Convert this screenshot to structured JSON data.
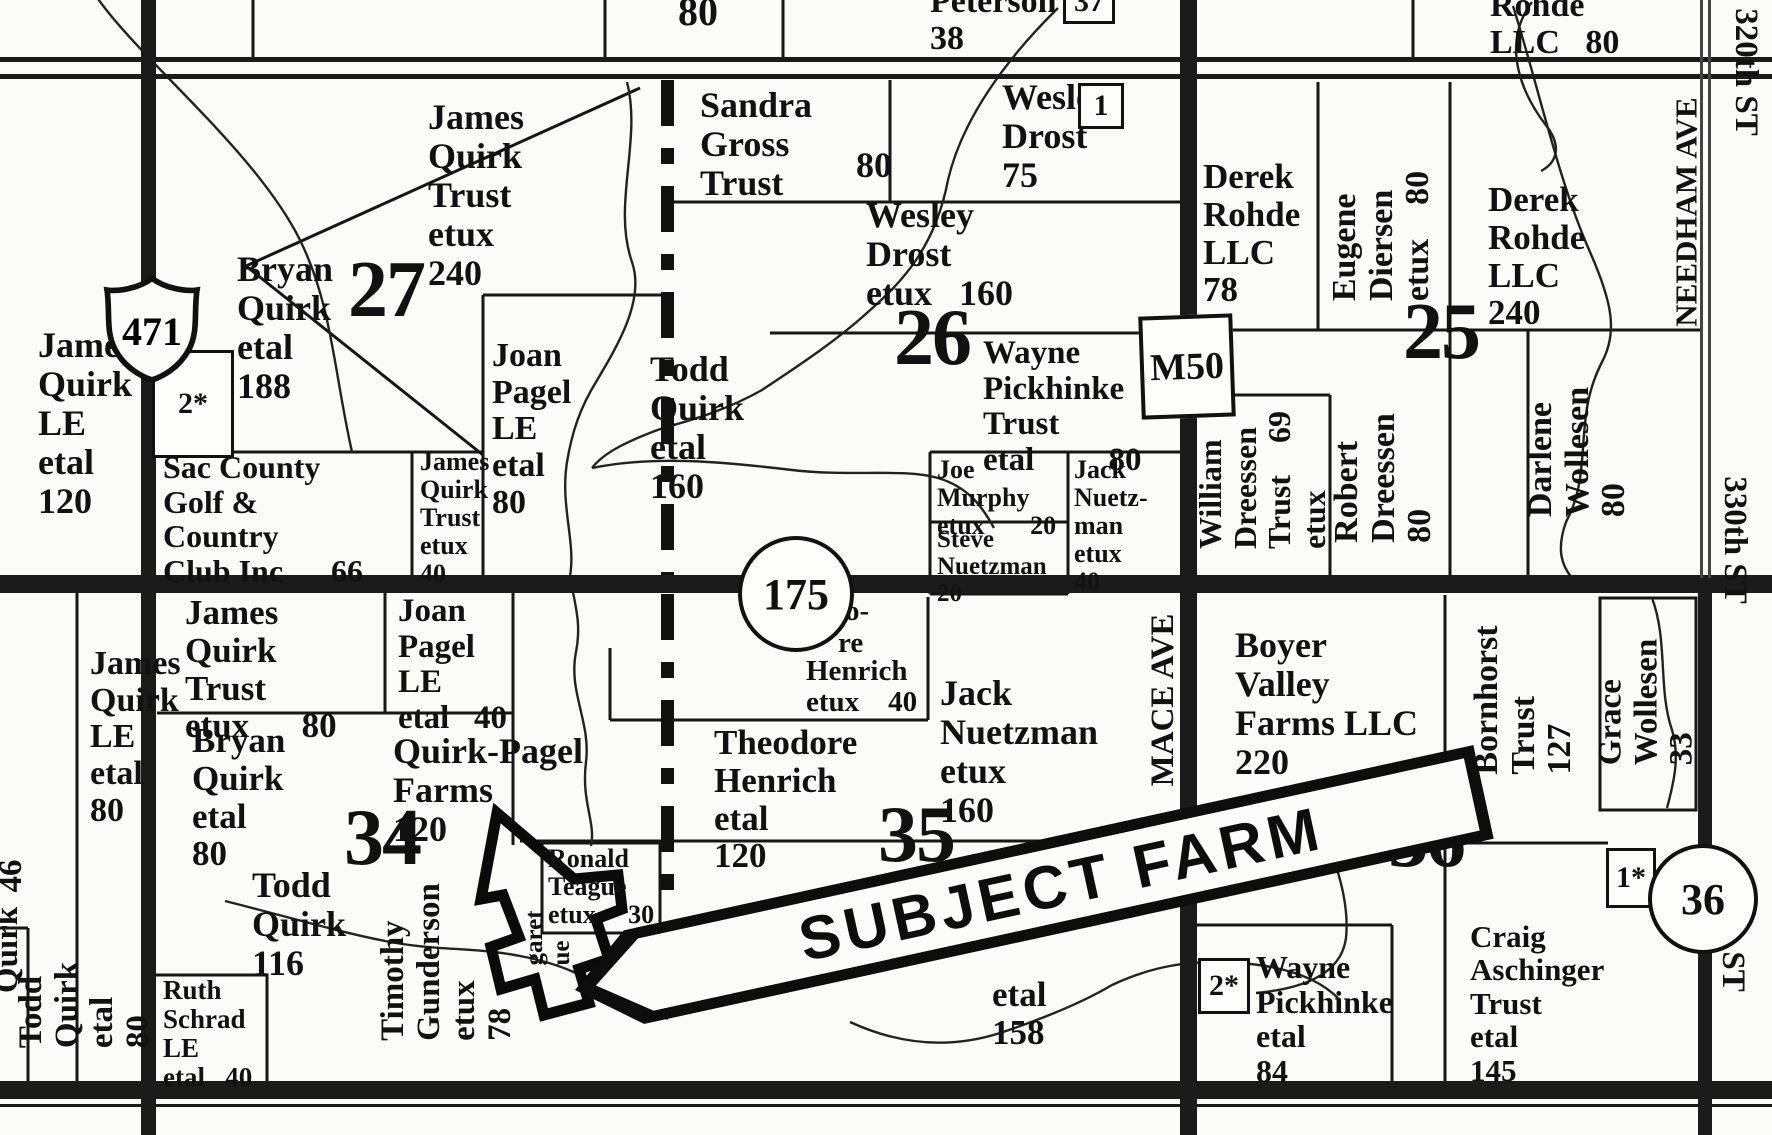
{
  "banner": {
    "label": "SUBJECT FARM"
  },
  "markers": {
    "us_shield": {
      "label": "471"
    },
    "m50_box": {
      "label": "M50"
    },
    "circle_175": {
      "label": "175"
    },
    "circle_36": {
      "label": "36"
    }
  },
  "section_numbers": [
    {
      "n": "27",
      "x": 348,
      "y": 250
    },
    {
      "n": "26",
      "x": 894,
      "y": 298
    },
    {
      "n": "25",
      "x": 1403,
      "y": 292
    },
    {
      "n": "34",
      "x": 344,
      "y": 798
    },
    {
      "n": "35",
      "x": 878,
      "y": 795
    },
    {
      "n": "36",
      "x": 1388,
      "y": 800
    }
  ],
  "badges": [
    {
      "t": "37",
      "x": 1063,
      "y": -20,
      "w": 46,
      "h": 38
    },
    {
      "t": "1",
      "x": 1078,
      "y": 83,
      "w": 40,
      "h": 40
    },
    {
      "t": "2*",
      "x": 152,
      "y": 350,
      "w": 76,
      "h": 102
    },
    {
      "t": "2*",
      "x": 1198,
      "y": 958,
      "w": 46,
      "h": 50
    },
    {
      "t": "1*",
      "x": 1606,
      "y": 848,
      "w": 44,
      "h": 54
    }
  ],
  "labels": [
    {
      "t": [
        "80"
      ],
      "x": 678,
      "y": -10,
      "fs": 40
    },
    {
      "t": [
        "Peterson",
        "38"
      ],
      "x": 930,
      "y": -16,
      "fs": 34
    },
    {
      "t": [
        "Rohde",
        "LLC   80"
      ],
      "x": 1490,
      "y": -12,
      "fs": 34
    },
    {
      "t": [
        "James",
        "Quirk",
        "Trust",
        "etux",
        "240"
      ],
      "x": 428,
      "y": 98,
      "fs": 36
    },
    {
      "t": [
        "Sandra",
        "Gross",
        "Trust"
      ],
      "x": 700,
      "y": 86,
      "fs": 36
    },
    {
      "t": [
        "80"
      ],
      "x": 856,
      "y": 146,
      "fs": 36
    },
    {
      "t": [
        "Wesley",
        "Drost",
        "75"
      ],
      "x": 1002,
      "y": 78,
      "fs": 36
    },
    {
      "t": [
        "Wesley",
        "Drost",
        "etux   160"
      ],
      "x": 866,
      "y": 196,
      "fs": 36
    },
    {
      "t": [
        "Derek",
        "Rohde",
        "LLC",
        "78"
      ],
      "x": 1203,
      "y": 158,
      "fs": 35
    },
    {
      "t": [
        "Derek",
        "Rohde",
        "LLC",
        "240"
      ],
      "x": 1488,
      "y": 181,
      "fs": 35
    },
    {
      "t": [
        "Bryan",
        "Quirk",
        "etal",
        "188"
      ],
      "x": 237,
      "y": 250,
      "fs": 36
    },
    {
      "t": [
        "James",
        "Quirk",
        "LE",
        "etal",
        "120"
      ],
      "x": 38,
      "y": 326,
      "fs": 36
    },
    {
      "t": [
        "Joan",
        "Pagel",
        "LE",
        "etal",
        "80"
      ],
      "x": 492,
      "y": 338,
      "fs": 34
    },
    {
      "t": [
        "Todd",
        "Quirk",
        "etal",
        "160"
      ],
      "x": 650,
      "y": 350,
      "fs": 36
    },
    {
      "t": [
        "Wayne",
        "Pickhinke",
        "Trust",
        "etal         80"
      ],
      "x": 983,
      "y": 336,
      "fs": 33
    },
    {
      "t": [
        "Sac County",
        "Golf &",
        "Country",
        "Club Inc      66"
      ],
      "x": 163,
      "y": 450,
      "fs": 32
    },
    {
      "t": [
        "James",
        "Quirk",
        "Trust",
        "etux",
        "40"
      ],
      "x": 420,
      "y": 448,
      "fs": 26
    },
    {
      "t": [
        "Joe",
        "Murphy",
        "etux       20"
      ],
      "x": 937,
      "y": 456,
      "fs": 26
    },
    {
      "t": [
        "Steve",
        "Nuetzman",
        "20"
      ],
      "x": 937,
      "y": 526,
      "fs": 25
    },
    {
      "t": [
        "Jack",
        "Nuetz-",
        "man",
        "etux",
        "40"
      ],
      "x": 1074,
      "y": 456,
      "fs": 26
    },
    {
      "t": [
        "James",
        "Quirk",
        "Trust",
        "etux      80"
      ],
      "x": 185,
      "y": 594,
      "fs": 35
    },
    {
      "t": [
        "Joan",
        "Pagel",
        "LE",
        "etal   40"
      ],
      "x": 398,
      "y": 594,
      "fs": 33
    },
    {
      "t": [
        "James",
        "Quirk",
        "LE",
        "etal",
        "80"
      ],
      "x": 90,
      "y": 646,
      "fs": 34
    },
    {
      "t": [
        "Bryan",
        "Quirk",
        "etal",
        "80"
      ],
      "x": 192,
      "y": 722,
      "fs": 35
    },
    {
      "t": [
        "Quirk-Pagel",
        "Farms",
        "120"
      ],
      "x": 393,
      "y": 732,
      "fs": 36
    },
    {
      "t": [
        "o-"
      ],
      "x": 845,
      "y": 596,
      "fs": 29
    },
    {
      "t": [
        "re"
      ],
      "x": 838,
      "y": 628,
      "fs": 29
    },
    {
      "t": [
        "Henrich",
        "etux    40"
      ],
      "x": 806,
      "y": 656,
      "fs": 29
    },
    {
      "t": [
        "Theodore",
        "Henrich",
        "etal",
        "120"
      ],
      "x": 714,
      "y": 724,
      "fs": 35
    },
    {
      "t": [
        "Jack",
        "Nuetzman",
        "etux",
        "160"
      ],
      "x": 940,
      "y": 674,
      "fs": 36
    },
    {
      "t": [
        "Boyer",
        "Valley",
        "Farms LLC",
        "220"
      ],
      "x": 1235,
      "y": 626,
      "fs": 36
    },
    {
      "t": [
        "Ronald",
        "Teague",
        "etux     30"
      ],
      "x": 548,
      "y": 845,
      "fs": 26
    },
    {
      "t": [
        "Todd",
        "Quirk",
        "116"
      ],
      "x": 252,
      "y": 866,
      "fs": 36
    },
    {
      "t": [
        "Ruth",
        "Schrad",
        "LE",
        "etal   40"
      ],
      "x": 163,
      "y": 976,
      "fs": 27
    },
    {
      "t": [
        "etal",
        "158"
      ],
      "x": 992,
      "y": 976,
      "fs": 35
    },
    {
      "t": [
        "D"
      ],
      "x": 734,
      "y": 916,
      "fs": 38
    },
    {
      "t": [
        "Wayne",
        "Pickhinke",
        "etal",
        "84"
      ],
      "x": 1256,
      "y": 950,
      "fs": 32
    },
    {
      "t": [
        "Craig",
        "Aschinger",
        "Trust",
        "etal",
        "145"
      ],
      "x": 1470,
      "y": 920,
      "fs": 31
    },
    {
      "t": [
        "*"
      ],
      "x": 150,
      "y": 402,
      "fs": 32
    },
    {
      "t": [
        "Eugene",
        "Diersen",
        "etux    80"
      ],
      "x": 1382,
      "y": 236,
      "fs": 34,
      "r": -90
    },
    {
      "t": [
        "William",
        "Dreessen",
        "Trust    69",
        "etux"
      ],
      "x": 1262,
      "y": 480,
      "fs": 32,
      "r": -90
    },
    {
      "t": [
        "Robert",
        "Dreessen",
        "80"
      ],
      "x": 1384,
      "y": 478,
      "fs": 34,
      "r": -90
    },
    {
      "t": [
        "Darlene",
        "Wollesen",
        "80"
      ],
      "x": 1578,
      "y": 452,
      "fs": 34,
      "r": -90
    },
    {
      "t": [
        "MACE AVE"
      ],
      "x": 1164,
      "y": 700,
      "fs": 33,
      "r": -90
    },
    {
      "t": [
        "NEEDHAM AVE"
      ],
      "x": 1686,
      "y": 212,
      "fs": 31,
      "r": -90
    },
    {
      "t": [
        "Bornhorst",
        "Trust",
        "127"
      ],
      "x": 1524,
      "y": 700,
      "fs": 34,
      "r": -90
    },
    {
      "t": [
        "Grace",
        "Wollesen",
        "33"
      ],
      "x": 1647,
      "y": 702,
      "fs": 33,
      "r": -90
    },
    {
      "t": [
        "Timothy",
        "Gunderson",
        "etux",
        "78"
      ],
      "x": 447,
      "y": 962,
      "fs": 33,
      "r": -90
    },
    {
      "t": [
        "Todd",
        "Quirk",
        "etal",
        "80"
      ],
      "x": 85,
      "y": 1005,
      "fs": 33,
      "r": -90
    },
    {
      "t": [
        "Quirk"
      ],
      "x": 8,
      "y": 950,
      "fs": 33,
      "r": -90
    },
    {
      "t": [
        "46"
      ],
      "x": 12,
      "y": 876,
      "fs": 33,
      "r": -90
    },
    {
      "t": [
        "garet",
        "ue"
      ],
      "x": 548,
      "y": 938,
      "fs": 25,
      "r": -90
    },
    {
      "t": [
        "320th ST"
      ],
      "x": 1745,
      "y": 72,
      "fs": 33,
      "r": 90
    },
    {
      "t": [
        "330th ST"
      ],
      "x": 1734,
      "y": 540,
      "fs": 33,
      "r": 90
    },
    {
      "t": [
        "340th ST"
      ],
      "x": 1732,
      "y": 928,
      "fs": 33,
      "r": 90
    }
  ]
}
